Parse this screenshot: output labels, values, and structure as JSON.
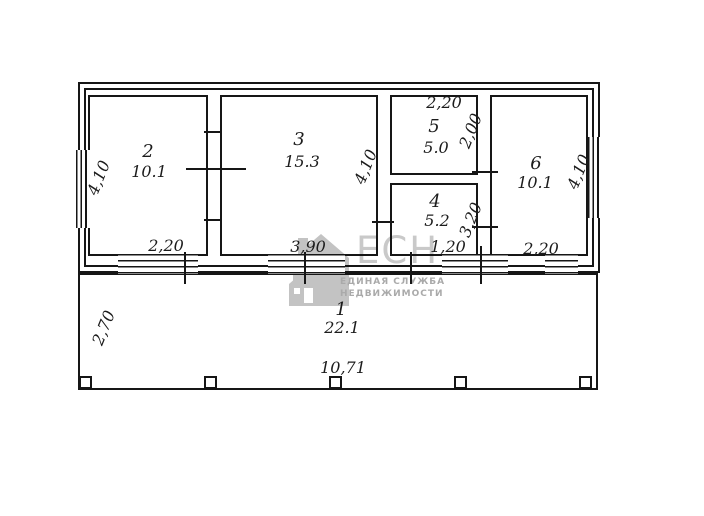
{
  "plan": {
    "rooms": {
      "r1": {
        "number": "1",
        "area": "22.1"
      },
      "r2": {
        "number": "2",
        "area": "10.1"
      },
      "r3": {
        "number": "3",
        "area": "15.3"
      },
      "r4": {
        "number": "4",
        "area": "5.2"
      },
      "r5": {
        "number": "5",
        "area": "5.0"
      },
      "r6": {
        "number": "6",
        "area": "10.1"
      }
    },
    "dims": {
      "room2_left": "4,10",
      "room2_bottom": "2,20",
      "room3_bottom": "3,90",
      "mid_vertical": "4,10",
      "room5_top": "2,20",
      "room5_right": "2,00",
      "room4_right": "3,20",
      "room4_bottom": "1,20",
      "room6_bottom": "2,20",
      "room6_right": "4,10",
      "veranda_left": "2,70",
      "total_width": "10,71"
    }
  },
  "watermark": {
    "logo": "ЕСН",
    "tagline_line1": "ЕДИНАЯ СЛУЖБА",
    "tagline_line2": "НЕДВИЖИМОСТИ",
    "accent_color": "#c9c9c9"
  }
}
